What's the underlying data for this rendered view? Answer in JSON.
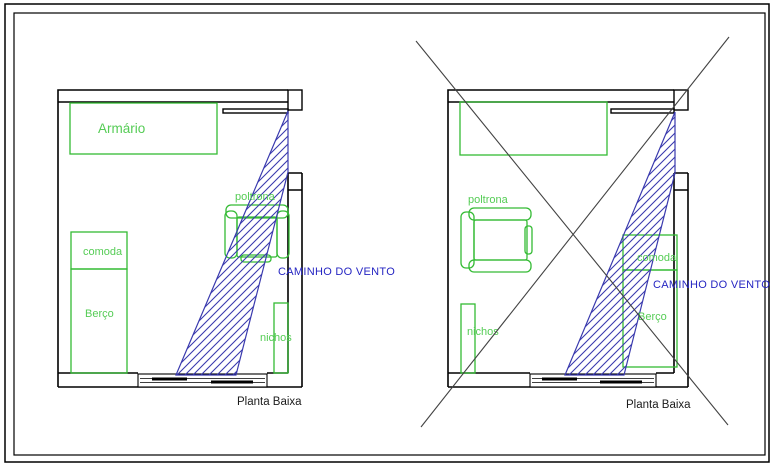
{
  "drawing": {
    "left_plan": {
      "caption": "Planta Baixa",
      "wind_label": "CAMINHO DO VENTO",
      "furniture": {
        "armario": "Armário",
        "comoda": "comoda",
        "berco": "Berço",
        "poltrona": "poltrona",
        "nichos": "nichos"
      }
    },
    "right_plan": {
      "caption": "Planta Baixa",
      "wind_label": "CAMINHO DO VENTO",
      "crossed_out": true,
      "furniture": {
        "comoda": "comoda",
        "berco": "Berço",
        "poltrona": "poltrona",
        "nichos": "nichos"
      }
    },
    "colors": {
      "wall": "#000000",
      "green": "#34bb34",
      "green-text": "#55cc55",
      "blue": "#3a3aae",
      "blue-text": "#2525c2",
      "cross": "#424242"
    }
  }
}
